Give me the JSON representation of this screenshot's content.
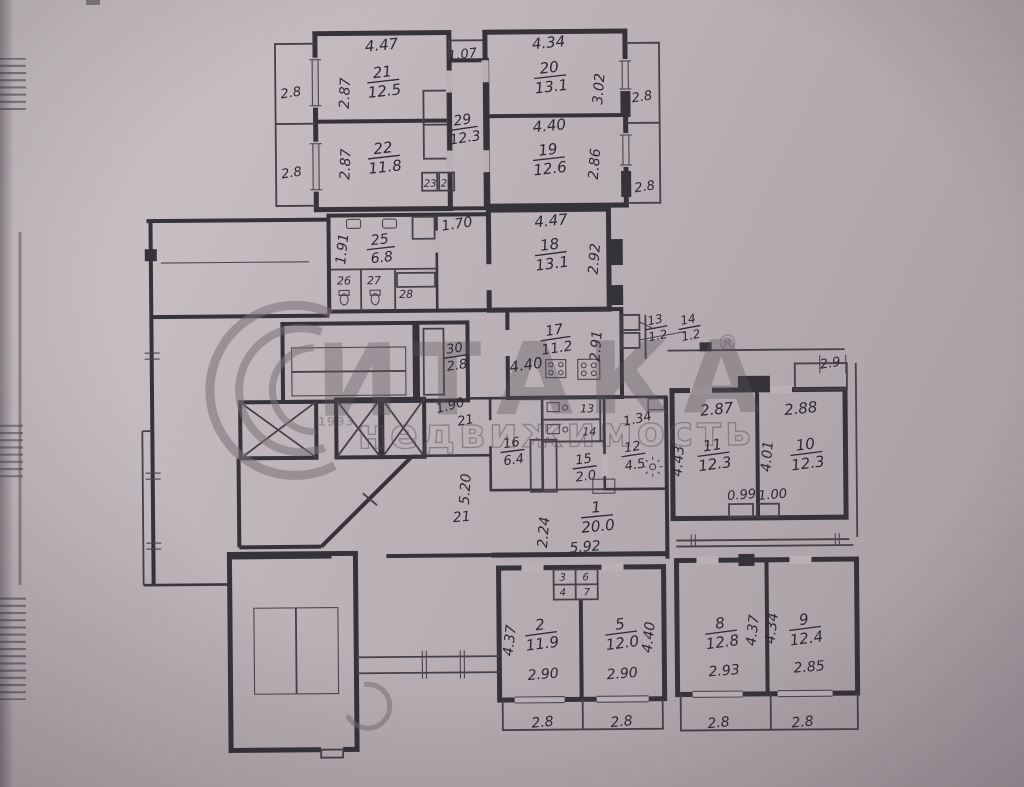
{
  "photo": {
    "paper_color": "#b9b1b5",
    "ink_color": "#35323a",
    "watermark_color": "#807a80"
  },
  "watermark": {
    "brand": "ИТАКА",
    "reg": "®",
    "subtitle": "недвижимость",
    "year": "1993"
  },
  "rooms": {
    "r1": {
      "num": "1",
      "area": "20.0",
      "h": "2.24",
      "w": "5.92"
    },
    "r2": {
      "num": "2",
      "area": "11.9",
      "h": "4.37",
      "w": "2.90"
    },
    "r3": {
      "num": "3"
    },
    "r4": {
      "num": "4"
    },
    "r5": {
      "num": "5",
      "area": "12.0",
      "h": "4.40",
      "w": "2.90"
    },
    "r6": {
      "num": "6"
    },
    "r7": {
      "num": "7"
    },
    "r8": {
      "num": "8",
      "area": "12.8",
      "h": "4.37",
      "w": "2.93"
    },
    "r9": {
      "num": "9",
      "area": "12.4",
      "h": "4.34",
      "w": "2.85"
    },
    "r10": {
      "num": "10",
      "area": "12.3",
      "w": "2.88",
      "h": "4.01"
    },
    "r11": {
      "num": "11",
      "area": "12.3",
      "w": "2.87",
      "h": "4.43"
    },
    "r12": {
      "num": "12",
      "area": "4.5",
      "w": "1.34"
    },
    "r13": {
      "num": "13",
      "area": "1.2"
    },
    "r14": {
      "num": "14",
      "area": "1.2"
    },
    "r13b": {
      "num": "13"
    },
    "r14b": {
      "num": "14"
    },
    "r15": {
      "num": "15",
      "area": "2.0"
    },
    "r16": {
      "num": "16",
      "area": "6.4"
    },
    "r17": {
      "num": "17",
      "area": "11.2",
      "h": "2.91",
      "w": "4.40"
    },
    "r18": {
      "num": "18",
      "area": "13.1",
      "w": "4.47",
      "h": "2.92"
    },
    "r19": {
      "num": "19",
      "area": "12.6",
      "w": "4.40",
      "h": "2.86"
    },
    "r20": {
      "num": "20",
      "area": "13.1",
      "w": "4.34",
      "h": "3.02"
    },
    "r21": {
      "num": "21",
      "area": "12.5",
      "w": "4.47",
      "h": "2.87"
    },
    "r22": {
      "num": "22",
      "area": "11.8",
      "h": "2.87"
    },
    "r23": {
      "num": "23"
    },
    "r24": {
      "num": "24"
    },
    "r25": {
      "num": "25",
      "area": "6.8",
      "h": "1.91"
    },
    "r26": {
      "num": "26"
    },
    "r27": {
      "num": "27"
    },
    "r28": {
      "num": "28"
    },
    "r29": {
      "num": "29",
      "area": "12.3",
      "top": "1.07"
    },
    "r30": {
      "num": "30",
      "area": "2.8"
    }
  },
  "dims": {
    "lobby": "1.70",
    "pass": "1.90",
    "pass_no": "21",
    "hall_h": "5.20",
    "hall_no": "21",
    "vent_l": "0.99",
    "vent_r": "1.00",
    "window_tr": "2.9"
  },
  "balconies": {
    "tl": [
      "2.8",
      "2.8"
    ],
    "tr": [
      "2.8",
      "2.8"
    ],
    "bottom": [
      "2.8",
      "2.8",
      "2.8",
      "2.8"
    ]
  }
}
